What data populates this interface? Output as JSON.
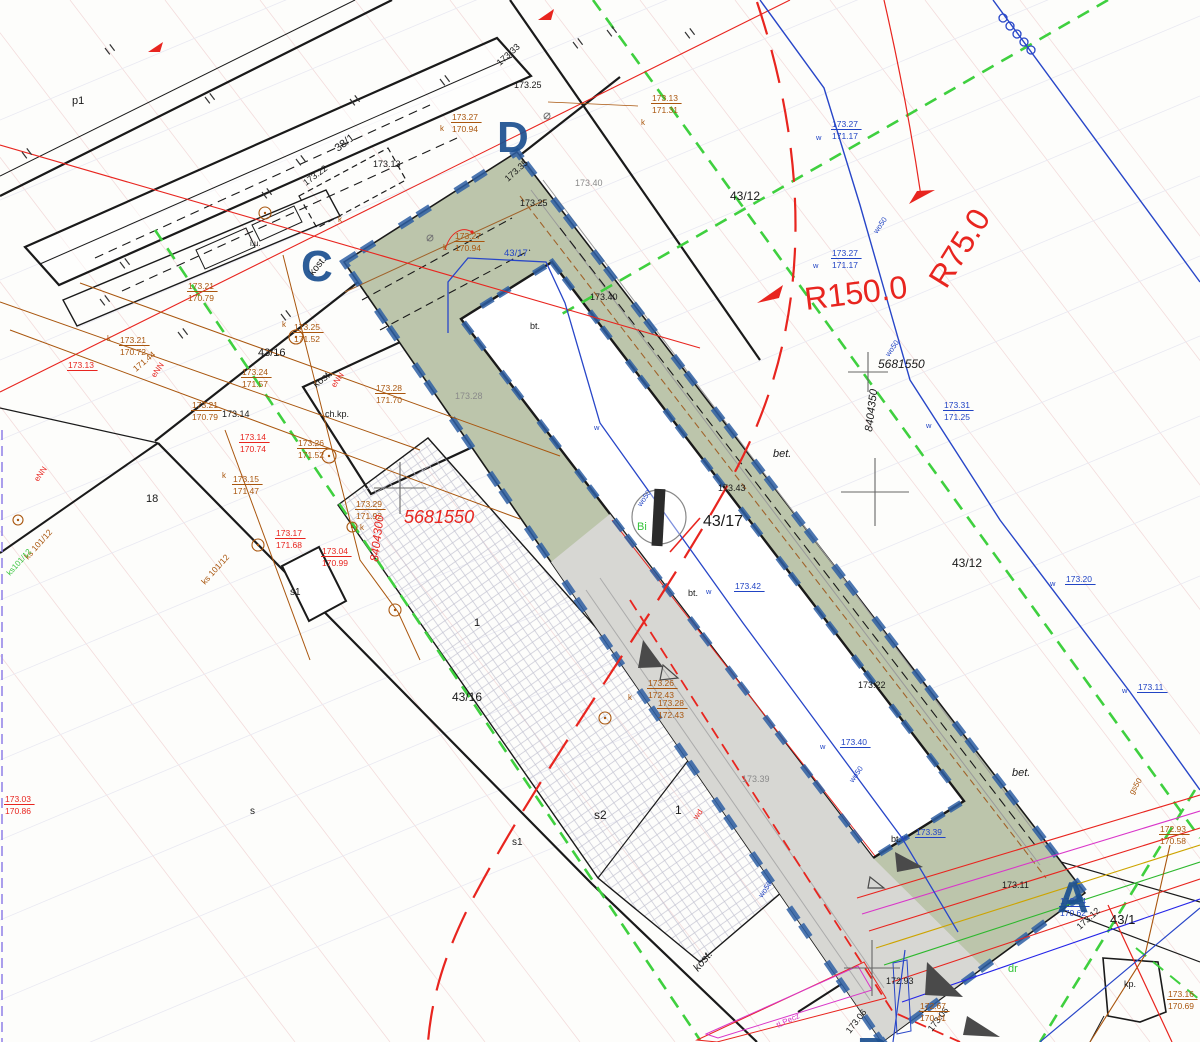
{
  "colors": {
    "black": "#1a1a1a",
    "gray": "#8a8a8a",
    "brown": "#a9560e",
    "red": "#e8251f",
    "blue": "#2144c4",
    "green": "#35c43a",
    "magenta": "#d936c9",
    "letter_blue": "#1c5090",
    "design_green_fill": "#bcc5ab",
    "pavement_gray_fill": "#d7d7d3",
    "dash_border_blue": "#2e5fa3",
    "green_dashed_line": "#3fd03f"
  },
  "map": {
    "corner_letters": [
      {
        "t": "D",
        "x": 497,
        "y": 152
      },
      {
        "t": "C",
        "x": 301,
        "y": 281
      },
      {
        "t": "A",
        "x": 1057,
        "y": 912
      },
      {
        "t": "B",
        "x": 857,
        "y": 1068
      }
    ],
    "radius_labels": [
      {
        "t": "R150.0",
        "x": 806,
        "y": 310,
        "s": 32,
        "c": "red",
        "r": -7
      },
      {
        "t": "R75.0",
        "x": 946,
        "y": 290,
        "s": 32,
        "c": "red",
        "r": -58
      }
    ],
    "grid_coord_labels": [
      {
        "t": "5681550",
        "x": 878,
        "y": 368,
        "s": 12,
        "it": 1
      },
      {
        "t": "8404350",
        "x": 872,
        "y": 432,
        "s": 11,
        "r": -83,
        "it": 1
      },
      {
        "t": "5681550",
        "x": 404,
        "y": 523,
        "s": 18,
        "c": "red",
        "it": 1
      },
      {
        "t": "8404300",
        "x": 378,
        "y": 562,
        "s": 12,
        "c": "red",
        "r": -83,
        "it": 1
      }
    ],
    "labels": [
      {
        "t": "p1",
        "x": 72,
        "y": 104,
        "s": 11
      },
      {
        "t": "38/1",
        "x": 338,
        "y": 152,
        "s": 11,
        "r": -37
      },
      {
        "t": "173.33",
        "x": 500,
        "y": 66,
        "s": 9,
        "r": -42
      },
      {
        "t": "173.25",
        "x": 514,
        "y": 88,
        "s": 9
      },
      {
        "t": "173.13",
        "x": 373,
        "y": 167,
        "s": 9
      },
      {
        "t": "173.22",
        "x": 306,
        "y": 186,
        "s": 9,
        "r": -37
      },
      {
        "t": "i.u.",
        "x": 250,
        "y": 246,
        "s": 8
      },
      {
        "t": "kost.",
        "x": 313,
        "y": 276,
        "s": 10,
        "r": -50
      },
      {
        "t": "173.35",
        "x": 508,
        "y": 182,
        "s": 9,
        "r": -42
      },
      {
        "t": "173.25",
        "x": 520,
        "y": 206,
        "s": 9
      },
      {
        "t": "173.40",
        "x": 590,
        "y": 300,
        "s": 9
      },
      {
        "t": "bt.",
        "x": 530,
        "y": 329,
        "s": 9
      },
      {
        "t": "43/16",
        "x": 258,
        "y": 356,
        "s": 11
      },
      {
        "t": "173.14",
        "x": 222,
        "y": 417,
        "s": 9
      },
      {
        "t": "kost.",
        "x": 316,
        "y": 388,
        "s": 10,
        "r": -38
      },
      {
        "t": "ch.kp.",
        "x": 325,
        "y": 417,
        "s": 9
      },
      {
        "t": "18",
        "x": 146,
        "y": 502,
        "s": 11
      },
      {
        "t": "43/12",
        "x": 730,
        "y": 200,
        "s": 12
      },
      {
        "t": "43/12",
        "x": 952,
        "y": 567,
        "s": 12
      },
      {
        "t": "43/17",
        "x": 703,
        "y": 526,
        "s": 16
      },
      {
        "t": "173.43",
        "x": 718,
        "y": 491,
        "s": 9
      },
      {
        "t": "bet.",
        "x": 773,
        "y": 457,
        "s": 11,
        "it": 1
      },
      {
        "t": "bet.",
        "x": 1012,
        "y": 776,
        "s": 11,
        "it": 1
      },
      {
        "t": "bt.",
        "x": 688,
        "y": 596,
        "s": 9
      },
      {
        "t": "bt.",
        "x": 891,
        "y": 842,
        "s": 9
      },
      {
        "t": "173.22",
        "x": 858,
        "y": 688,
        "s": 9
      },
      {
        "t": "1",
        "x": 474,
        "y": 626,
        "s": 11
      },
      {
        "t": "43/16",
        "x": 452,
        "y": 701,
        "s": 12
      },
      {
        "t": "s",
        "x": 250,
        "y": 814,
        "s": 10
      },
      {
        "t": "s1",
        "x": 290,
        "y": 595,
        "s": 10
      },
      {
        "t": "s1",
        "x": 512,
        "y": 845,
        "s": 10
      },
      {
        "t": "s2",
        "x": 594,
        "y": 819,
        "s": 12
      },
      {
        "t": "1",
        "x": 675,
        "y": 814,
        "s": 12
      },
      {
        "t": "43/1",
        "x": 1110,
        "y": 924,
        "s": 13
      },
      {
        "t": "kost.",
        "x": 698,
        "y": 972,
        "s": 11,
        "r": -50,
        "it": 1
      },
      {
        "t": "kp.",
        "x": 1124,
        "y": 987,
        "s": 9
      },
      {
        "t": "172.93",
        "x": 886,
        "y": 984,
        "s": 9
      },
      {
        "t": "173.06",
        "x": 850,
        "y": 1034,
        "s": 9,
        "r": -52
      },
      {
        "t": "173.06",
        "x": 932,
        "y": 1032,
        "s": 9,
        "r": -52
      },
      {
        "t": "173.12",
        "x": 1080,
        "y": 930,
        "s": 9,
        "r": -42
      },
      {
        "t": "173.11",
        "x": 1002,
        "y": 888,
        "s": 9
      },
      {
        "t": "173.40",
        "x": 575,
        "y": 186,
        "s": 9,
        "c": "gray"
      },
      {
        "t": "173.28",
        "x": 455,
        "y": 399,
        "s": 9,
        "c": "gray"
      },
      {
        "t": "173.39",
        "x": 742,
        "y": 782,
        "s": 9,
        "c": "gray"
      },
      {
        "t": "173.14",
        "b": "170.74",
        "x": 240,
        "y": 440,
        "c": "red"
      },
      {
        "t": "173.17",
        "b": "171.68",
        "x": 276,
        "y": 536,
        "c": "red"
      },
      {
        "t": "173.04",
        "b": "170.99",
        "x": 322,
        "y": 554,
        "c": "red"
      },
      {
        "t": "173.03",
        "b": "170.86",
        "x": 5,
        "y": 802,
        "c": "red"
      },
      {
        "t": "173.13",
        "x": 68,
        "y": 368,
        "s": 8.5,
        "c": "red",
        "u": 1
      },
      {
        "t": "eNN",
        "x": 155,
        "y": 378,
        "s": 8,
        "c": "red",
        "r": -55
      },
      {
        "t": "eNN",
        "x": 38,
        "y": 482,
        "s": 8,
        "c": "red",
        "r": -55
      },
      {
        "t": "eNN",
        "x": 335,
        "y": 388,
        "s": 8,
        "c": "red",
        "r": -55
      },
      {
        "t": "wd",
        "x": 697,
        "y": 820,
        "s": 8,
        "c": "red",
        "r": -55
      },
      {
        "t": "173.27",
        "b": "170.94",
        "x": 452,
        "y": 120,
        "c": "brown"
      },
      {
        "t": "k",
        "x": 440,
        "y": 131,
        "s": 8,
        "c": "brown"
      },
      {
        "t": "173.27",
        "b": "170.94",
        "x": 455,
        "y": 239,
        "c": "brown"
      },
      {
        "t": "k",
        "x": 443,
        "y": 250,
        "s": 8,
        "c": "brown"
      },
      {
        "t": "173.13",
        "b": "171.31",
        "x": 652,
        "y": 101,
        "c": "brown"
      },
      {
        "t": "k",
        "x": 641,
        "y": 125,
        "s": 8,
        "c": "brown"
      },
      {
        "t": "173.21",
        "b": "170.79",
        "x": 188,
        "y": 289,
        "c": "brown"
      },
      {
        "t": "173.21",
        "b": "170.72",
        "x": 120,
        "y": 343,
        "c": "brown"
      },
      {
        "t": "k",
        "x": 107,
        "y": 341,
        "s": 8,
        "c": "brown"
      },
      {
        "t": "171.44",
        "x": 136,
        "y": 372,
        "s": 8.5,
        "c": "brown",
        "r": -40
      },
      {
        "t": "173.21",
        "b": "170.79",
        "x": 192,
        "y": 408,
        "c": "brown"
      },
      {
        "t": "173.15",
        "b": "171.47",
        "x": 233,
        "y": 482,
        "c": "brown"
      },
      {
        "t": "k",
        "x": 222,
        "y": 478,
        "s": 8,
        "c": "brown"
      },
      {
        "t": "173.24",
        "b": "171.57",
        "x": 242,
        "y": 375,
        "c": "brown"
      },
      {
        "t": "173.25",
        "b": "171.52",
        "x": 294,
        "y": 330,
        "c": "brown"
      },
      {
        "t": "k",
        "x": 282,
        "y": 327,
        "s": 8,
        "c": "brown"
      },
      {
        "t": "173.26",
        "b": "171.52",
        "x": 298,
        "y": 446,
        "c": "brown"
      },
      {
        "t": "173.28",
        "b": "171.70",
        "x": 376,
        "y": 391,
        "c": "brown"
      },
      {
        "t": "173.29",
        "b": "171.92",
        "x": 356,
        "y": 507,
        "c": "brown"
      },
      {
        "t": "k",
        "x": 360,
        "y": 530,
        "s": 8,
        "c": "brown"
      },
      {
        "t": "ks 101/12",
        "x": 205,
        "y": 585,
        "s": 8.5,
        "c": "brown",
        "r": -48
      },
      {
        "t": "ks 101/12",
        "x": 28,
        "y": 560,
        "s": 8.5,
        "c": "brown",
        "r": -48
      },
      {
        "t": "173.26",
        "b": "172.43",
        "x": 648,
        "y": 686,
        "c": "brown"
      },
      {
        "t": "173.28",
        "b": "172.43",
        "x": 658,
        "y": 706,
        "c": "brown"
      },
      {
        "t": "k",
        "x": 628,
        "y": 700,
        "s": 8,
        "c": "brown"
      },
      {
        "t": "172.93",
        "b": "170.58",
        "x": 1160,
        "y": 832,
        "c": "brown"
      },
      {
        "t": "173.16",
        "b": "170.69",
        "x": 1168,
        "y": 997,
        "c": "brown"
      },
      {
        "t": "172.67",
        "b": "170.41",
        "x": 920,
        "y": 1009,
        "c": "brown"
      },
      {
        "t": "gs50",
        "x": 1133,
        "y": 795,
        "s": 8,
        "c": "brown",
        "r": -58
      },
      {
        "t": "k",
        "x": 338,
        "y": 222,
        "s": 8,
        "c": "brown"
      },
      {
        "t": "173.27",
        "b": "171.17",
        "x": 832,
        "y": 127,
        "c": "blue"
      },
      {
        "t": "w",
        "x": 816,
        "y": 140,
        "s": 7.5,
        "c": "blue"
      },
      {
        "t": "173.27",
        "b": "171.17",
        "x": 832,
        "y": 256,
        "c": "blue"
      },
      {
        "t": "w",
        "x": 813,
        "y": 268,
        "s": 7.5,
        "c": "blue"
      },
      {
        "t": "173.31",
        "b": "171.25",
        "x": 944,
        "y": 408,
        "c": "blue"
      },
      {
        "t": "w",
        "x": 926,
        "y": 428,
        "s": 7.5,
        "c": "blue"
      },
      {
        "t": "173.20",
        "x": 1066,
        "y": 582,
        "c": "blue",
        "u": 1
      },
      {
        "t": "w",
        "x": 1050,
        "y": 586,
        "s": 7.5,
        "c": "blue"
      },
      {
        "t": "173.11",
        "x": 1138,
        "y": 690,
        "c": "blue",
        "u": 1
      },
      {
        "t": "w",
        "x": 1122,
        "y": 693,
        "s": 7.5,
        "c": "blue"
      },
      {
        "t": "173.42",
        "x": 735,
        "y": 589,
        "c": "blue",
        "u": 1
      },
      {
        "t": "w",
        "x": 706,
        "y": 594,
        "s": 7.5,
        "c": "blue"
      },
      {
        "t": "173.40",
        "x": 841,
        "y": 745,
        "c": "blue",
        "u": 1
      },
      {
        "t": "w",
        "x": 820,
        "y": 749,
        "s": 7.5,
        "c": "blue"
      },
      {
        "t": "173.39",
        "x": 916,
        "y": 835,
        "c": "blue",
        "u": 1
      },
      {
        "t": "w",
        "x": 902,
        "y": 840,
        "s": 7.5,
        "c": "blue"
      },
      {
        "t": "172.94",
        "b": "170.62",
        "x": 1060,
        "y": 904,
        "c": "blue"
      },
      {
        "t": "43/17",
        "x": 504,
        "y": 256,
        "s": 9.5,
        "c": "blue"
      },
      {
        "t": "wo50",
        "x": 877,
        "y": 234,
        "s": 7.5,
        "c": "blue",
        "r": -55
      },
      {
        "t": "wo50",
        "x": 889,
        "y": 357,
        "s": 7.5,
        "c": "blue",
        "r": -55
      },
      {
        "t": "wo50",
        "x": 641,
        "y": 507,
        "s": 7.5,
        "c": "blue",
        "r": -55
      },
      {
        "t": "wo50",
        "x": 853,
        "y": 783,
        "s": 7.5,
        "c": "blue",
        "r": -55
      },
      {
        "t": "wo50",
        "x": 762,
        "y": 898,
        "s": 7.5,
        "c": "blue",
        "r": -55
      },
      {
        "t": "w",
        "x": 594,
        "y": 430,
        "s": 7.5,
        "c": "blue"
      },
      {
        "t": "Bi",
        "x": 637,
        "y": 530,
        "s": 11,
        "c": "green"
      },
      {
        "t": "dr",
        "x": 1008,
        "y": 972,
        "s": 11,
        "c": "green"
      },
      {
        "t": "ks101/12",
        "x": 10,
        "y": 576,
        "s": 8,
        "c": "green",
        "r": -48
      },
      {
        "t": "tLPecz",
        "x": 778,
        "y": 1028,
        "s": 8,
        "c": "magenta",
        "r": -25
      }
    ],
    "fence_ticks": [
      [
        105,
        48
      ],
      [
        22,
        152
      ],
      [
        205,
        97
      ],
      [
        296,
        159
      ],
      [
        350,
        99
      ],
      [
        440,
        79
      ],
      [
        573,
        42
      ],
      [
        607,
        30
      ],
      [
        100,
        299
      ],
      [
        281,
        314
      ],
      [
        262,
        192
      ],
      [
        120,
        262
      ],
      [
        178,
        332
      ],
      [
        685,
        32
      ]
    ],
    "crosses": [
      [
        400,
        488,
        26
      ],
      [
        868,
        372,
        20
      ],
      [
        875,
        492,
        34
      ],
      [
        872,
        968,
        28
      ]
    ],
    "utility_circles": [
      [
        296,
        337,
        7
      ],
      [
        329,
        456,
        7
      ],
      [
        352,
        527,
        5
      ],
      [
        258,
        545,
        6
      ],
      [
        395,
        610,
        6
      ],
      [
        605,
        718,
        6
      ],
      [
        265,
        213,
        6
      ],
      [
        18,
        520,
        5
      ]
    ],
    "hydrant_circles": [
      [
        1003,
        18
      ],
      [
        1010,
        26
      ],
      [
        1017,
        34
      ],
      [
        1024,
        42
      ],
      [
        1031,
        50
      ]
    ],
    "triangles_filled": [
      [
        643,
        640,
        663,
        667,
        638,
        668
      ],
      [
        895,
        852,
        923,
        867,
        897,
        872
      ],
      [
        927,
        962,
        963,
        997,
        925,
        995
      ],
      [
        967,
        1016,
        1000,
        1037,
        963,
        1035
      ]
    ],
    "triangles_outline": [
      [
        663,
        665,
        678,
        678,
        660,
        680
      ],
      [
        870,
        877,
        884,
        888,
        868,
        888
      ]
    ],
    "red_arrows": [
      [
        935,
        190,
        909,
        204,
        917,
        191
      ],
      [
        757,
        303,
        783,
        285,
        779,
        298
      ],
      [
        538,
        20,
        554,
        9,
        551,
        20
      ],
      [
        148,
        52,
        163,
        42,
        160,
        52
      ]
    ]
  }
}
